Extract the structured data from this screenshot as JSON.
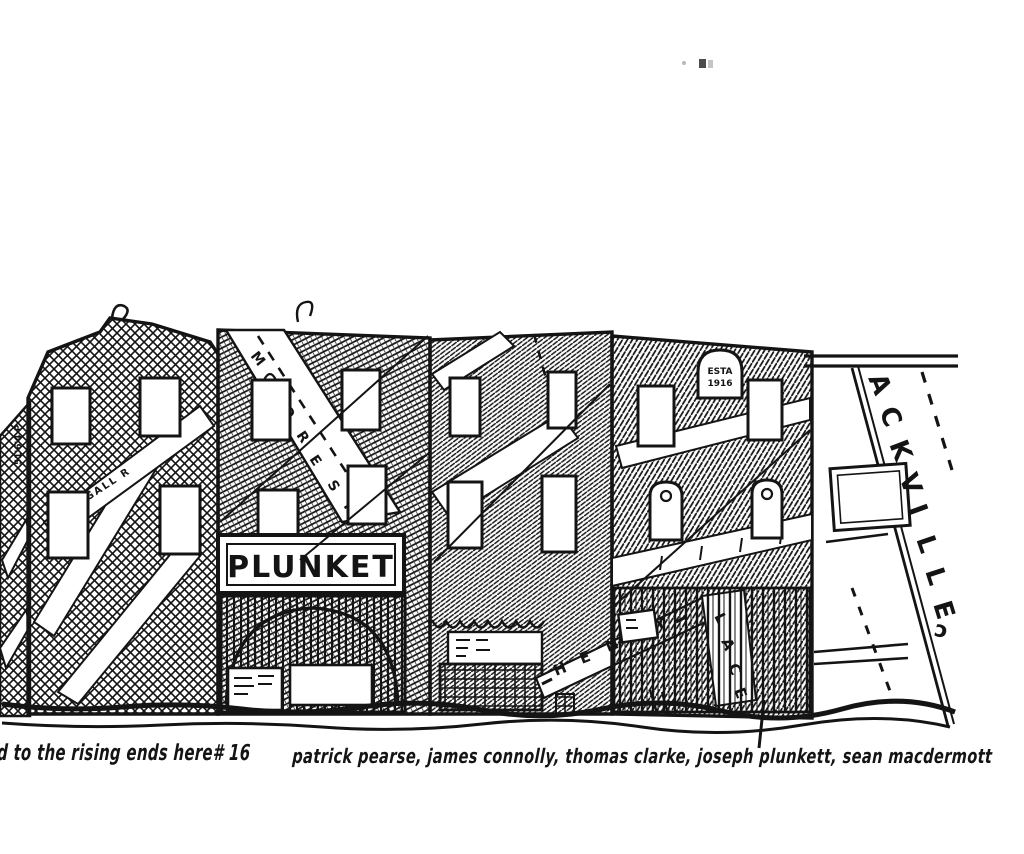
{
  "colors": {
    "paper": "#ffffff",
    "ink": "#141414"
  },
  "caption": {
    "part1": "road to the rising ends here# 16",
    "part2": "patrick pearse, james connolly, thomas clarke, joseph plunkett, sean macdermott"
  },
  "signs": {
    "shopfront": "PLUNKET",
    "plaque": {
      "line1": "ESTA",
      "line2": "1916"
    }
  },
  "streets": {
    "moore": {
      "name": "MOORE ST",
      "letters": [
        "M",
        "O",
        "O",
        "R",
        "E",
        "S",
        "T"
      ]
    },
    "henry": {
      "name": "HENRY",
      "letters": [
        "H",
        "E",
        "N",
        "R",
        "Y"
      ]
    },
    "henry_place": {
      "name": "PLACE",
      "letters": [
        "L",
        "A",
        "C",
        "E"
      ]
    },
    "sackville": {
      "name": "SACKVILLE",
      "letters": [
        "A",
        "C",
        "K",
        "V",
        "I",
        "L",
        "L",
        "E"
      ]
    },
    "side_lane": {
      "name": "RIGGALL R"
    }
  },
  "margin_notes": {
    "left_vertical": "51'6'4 P",
    "corner_glyph": "ɔ"
  }
}
